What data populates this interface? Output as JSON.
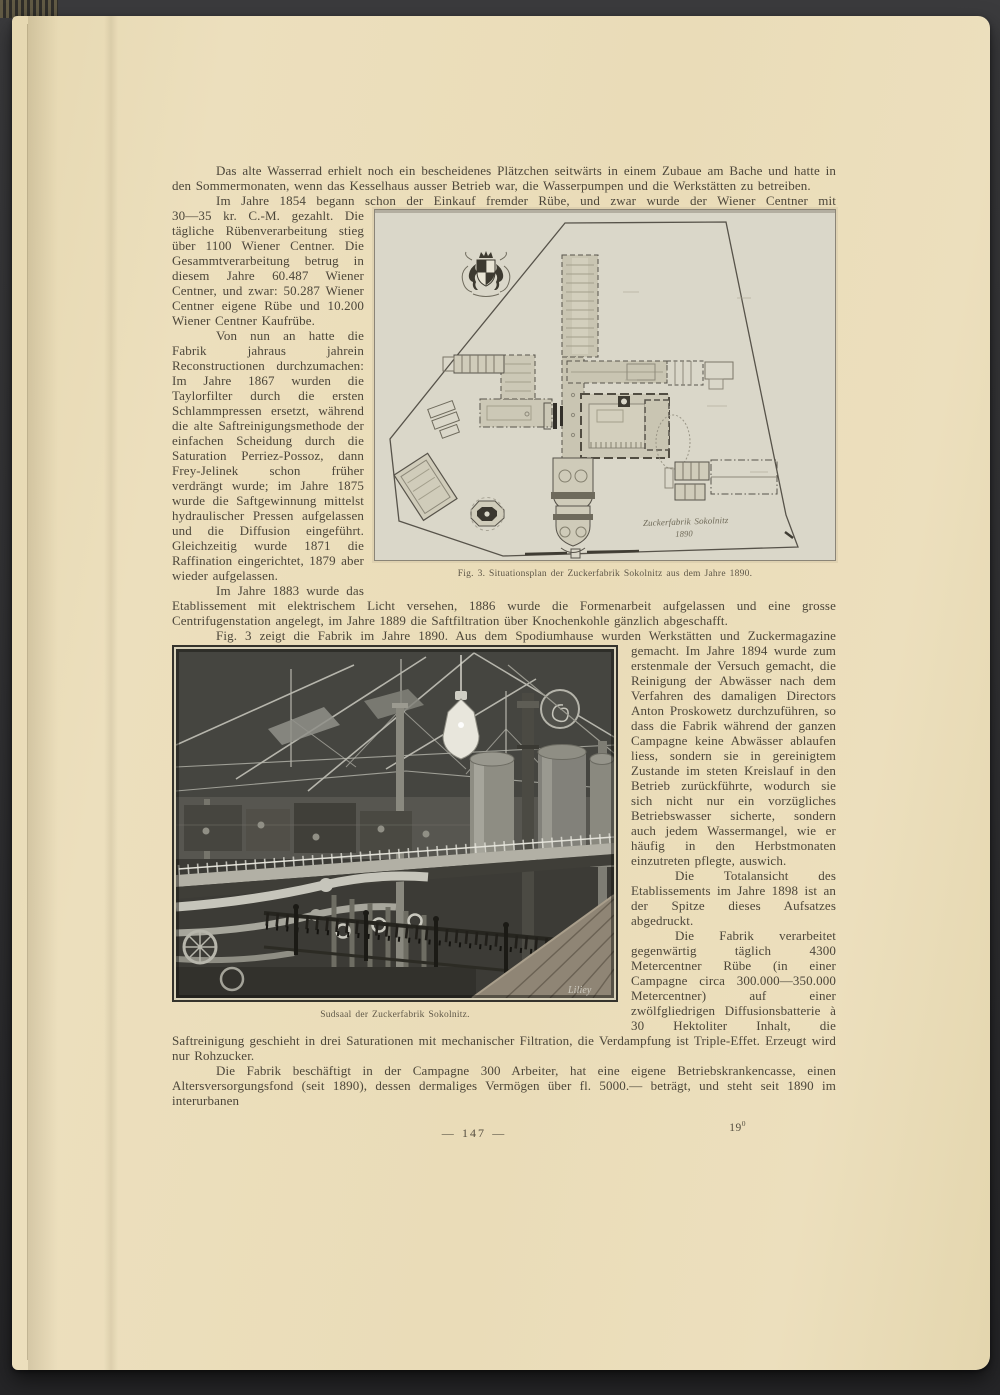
{
  "page": {
    "footer": "—  147  —",
    "signature_mark": "19",
    "signature_sup": "0"
  },
  "content": {
    "para1": "Das alte Wasserrad erhielt noch ein bescheidenes Plätzchen seitwärts in einem Zubaue am Bache und hatte in den Sommermonaten, wenn das Kesselhaus ausser Betrieb war, die Wasserpumpen und die Werkstätten zu betreiben.",
    "para2_intro": "Im Jahre 1854 begann schon der Einkauf fremder Rübe, und zwar wurde der Wiener Centner mit",
    "para2_rest": "30—35 kr. C.-M. gezahlt. Die tägliche Rübenverarbeitung stieg über 1100 Wiener Centner. Die Gesammtverarbeitung betrug in diesem Jahre 60.487 Wiener Centner, und zwar: 50.287 Wiener Centner eigene Rübe und 10.200 Wiener Centner Kaufrübe.",
    "para3": "Von nun an hatte die Fabrik jahraus jahrein Reconstructionen durchzumachen: Im Jahre 1867 wurden die Taylorfilter durch die ersten Schlammpressen ersetzt, während die alte Saftreinigungsmethode der einfachen Scheidung durch die Saturation Perriez-Possoz, dann Frey-Jelinek schon früher verdrängt wurde; im Jahre 1875 wurde die Saftgewinnung mittelst hydraulischer Pressen aufgelassen und die Diffusion eingeführt. Gleichzeitig wurde 1871 die Raffination eingerichtet, 1879 aber wieder aufgelassen.",
    "para4": "Im Jahre 1883 wurde das Etablissement mit elektrischem Licht versehen, 1886 wurde die Formenarbeit aufgelassen und eine grosse Centrifugenstation angelegt, im Jahre 1889 die Saftfiltration über Knochenkohle gänzlich abgeschafft.",
    "para5_intro": "Fig. 3 zeigt die Fabrik im Jahre 1890.  Aus dem Spodiumhause wurden Werkstätten und Zuckermagazine",
    "para5_rest": "gemacht. Im Jahre 1894 wurde zum erstenmale der Versuch gemacht, die Reinigung der Abwässer nach dem Verfahren des damaligen Directors Anton Proskowetz durchzuführen, so dass die Fabrik während der ganzen Campagne keine Abwässer ablaufen liess, sondern sie in gereinigtem Zustande im steten Kreislauf in den Betrieb zurückführte, wodurch sie sich nicht nur ein vorzügliches Betriebswasser sicherte, sondern auch jedem Wassermangel, wie er häufig in den Herbstmonaten einzutreten pflegte, auswich.",
    "para6": "Die Totalansicht des Etablissements im Jahre 1898 ist an der Spitze dieses Aufsatzes abgedruckt.",
    "para7": "Die Fabrik verarbeitet gegenwärtig täglich 4300 Metercentner Rübe (in einer Campagne circa 300.000—350.000 Metercentner) auf einer zwölfgliedrigen Diffusionsbatterie à 30 Hektoliter Inhalt, die Saftreinigung geschieht in drei Saturationen mit mechanischer Filtration, die Verdampfung ist Triple-Effet.  Erzeugt wird nur Rohzucker.",
    "para8": "Die Fabrik beschäftigt in der Campagne 300 Arbeiter, hat eine eigene Betriebskrankencasse, einen Altersversorgungsfond (seit 1890), dessen dermaliges Vermögen über fl. 5000.— beträgt, und steht seit 1890 im interurbanen"
  },
  "figure3": {
    "caption": "Fig. 3. Situationsplan der Zuckerfabrik Sokolnitz aus dem Jahre 1890.",
    "plan_label": "Zuckerfabrik Sokolnitz",
    "plan_year": "1890"
  },
  "photo": {
    "caption": "Sudsaal der Zuckerfabrik Sokolnitz.",
    "signature": "Liliey"
  },
  "colors": {
    "paper": "#ecdfbd",
    "ink": "#4c463a",
    "backdrop": "#343436",
    "plan_paper": "#dad7c9"
  }
}
